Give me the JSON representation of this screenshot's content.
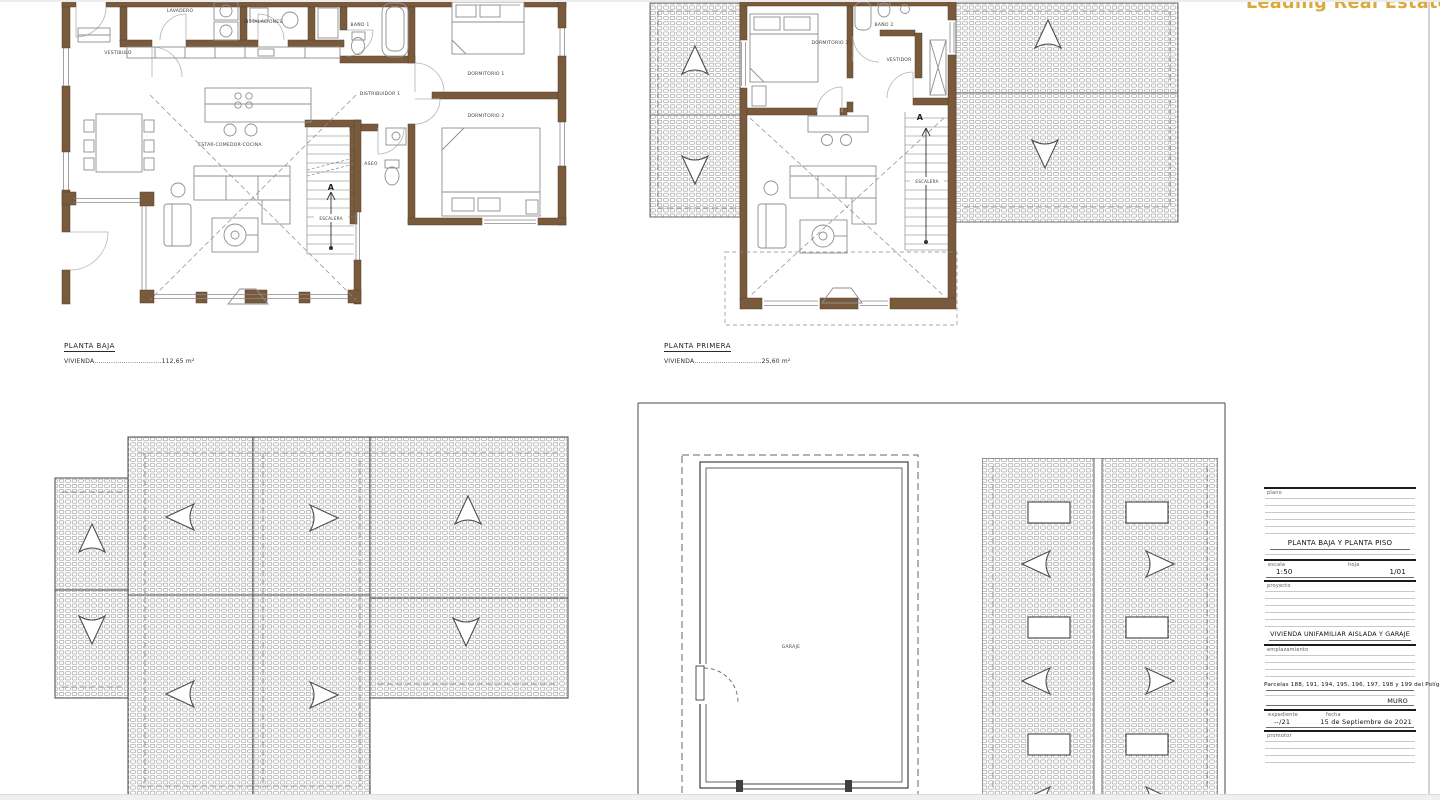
{
  "logo": {
    "text": "Leading Real Estate",
    "color": "#DBA93C"
  },
  "colors": {
    "wall": "#7a5a3d",
    "accent": "#DBA93C",
    "hatch": "#979797"
  },
  "ground_floor": {
    "title": "PLANTA BAJA",
    "area": {
      "label": "VIVIENDA",
      "dots": "................................",
      "value": "112,65 m²"
    },
    "labels": {
      "lavadero": "LAVADERO",
      "instalaciones": "INSTALACIONES",
      "vestibulo": "VESTIBULO",
      "estar_comedor_cocina": "ESTAR-COMEDOR-COCINA",
      "distribuidor": "DISTRIBUIDOR 1",
      "bano1": "BAÑO 1",
      "dormitorio1": "DORMITORIO 1",
      "dormitorio2": "DORMITORIO 2",
      "aseo": "ASEO",
      "escalera": "ESCALERA",
      "stair_letter": "A"
    }
  },
  "first_floor": {
    "title": "PLANTA PRIMERA",
    "area": {
      "label": "VIVIENDA",
      "dots": "................................",
      "value": "25,60 m²"
    },
    "labels": {
      "dormitorio3": "DORMITORIO 3",
      "bano2": "BAÑO 2",
      "vestidor": "VESTIDOR",
      "escalera": "ESCALERA",
      "stair_letter": "A"
    }
  },
  "garage": {
    "label": "GARAJE"
  },
  "title_block": {
    "plano_label": "plano",
    "plano_value": "PLANTA BAJA Y PLANTA PISO",
    "escala_label": "escala",
    "escala_value": "1:50",
    "hoja_label": "hoja",
    "hoja_value": "1/01",
    "proyecto_label": "proyecto",
    "proyecto_value": "VIVIENDA UNIFAMILIAR AISLADA Y GARAJE",
    "emplazamiento_label": "emplazamiento",
    "emplazamiento_value": "Parcelas 188, 191, 194, 195, 196, 197, 198 y 199 del Polígono 2",
    "municipio": "MURO",
    "expediente_label": "expediente",
    "expediente_value": "--/21",
    "fecha_label": "fecha",
    "fecha_value": "15 de Septiembre de 2021",
    "promotor_label": "promotor"
  }
}
